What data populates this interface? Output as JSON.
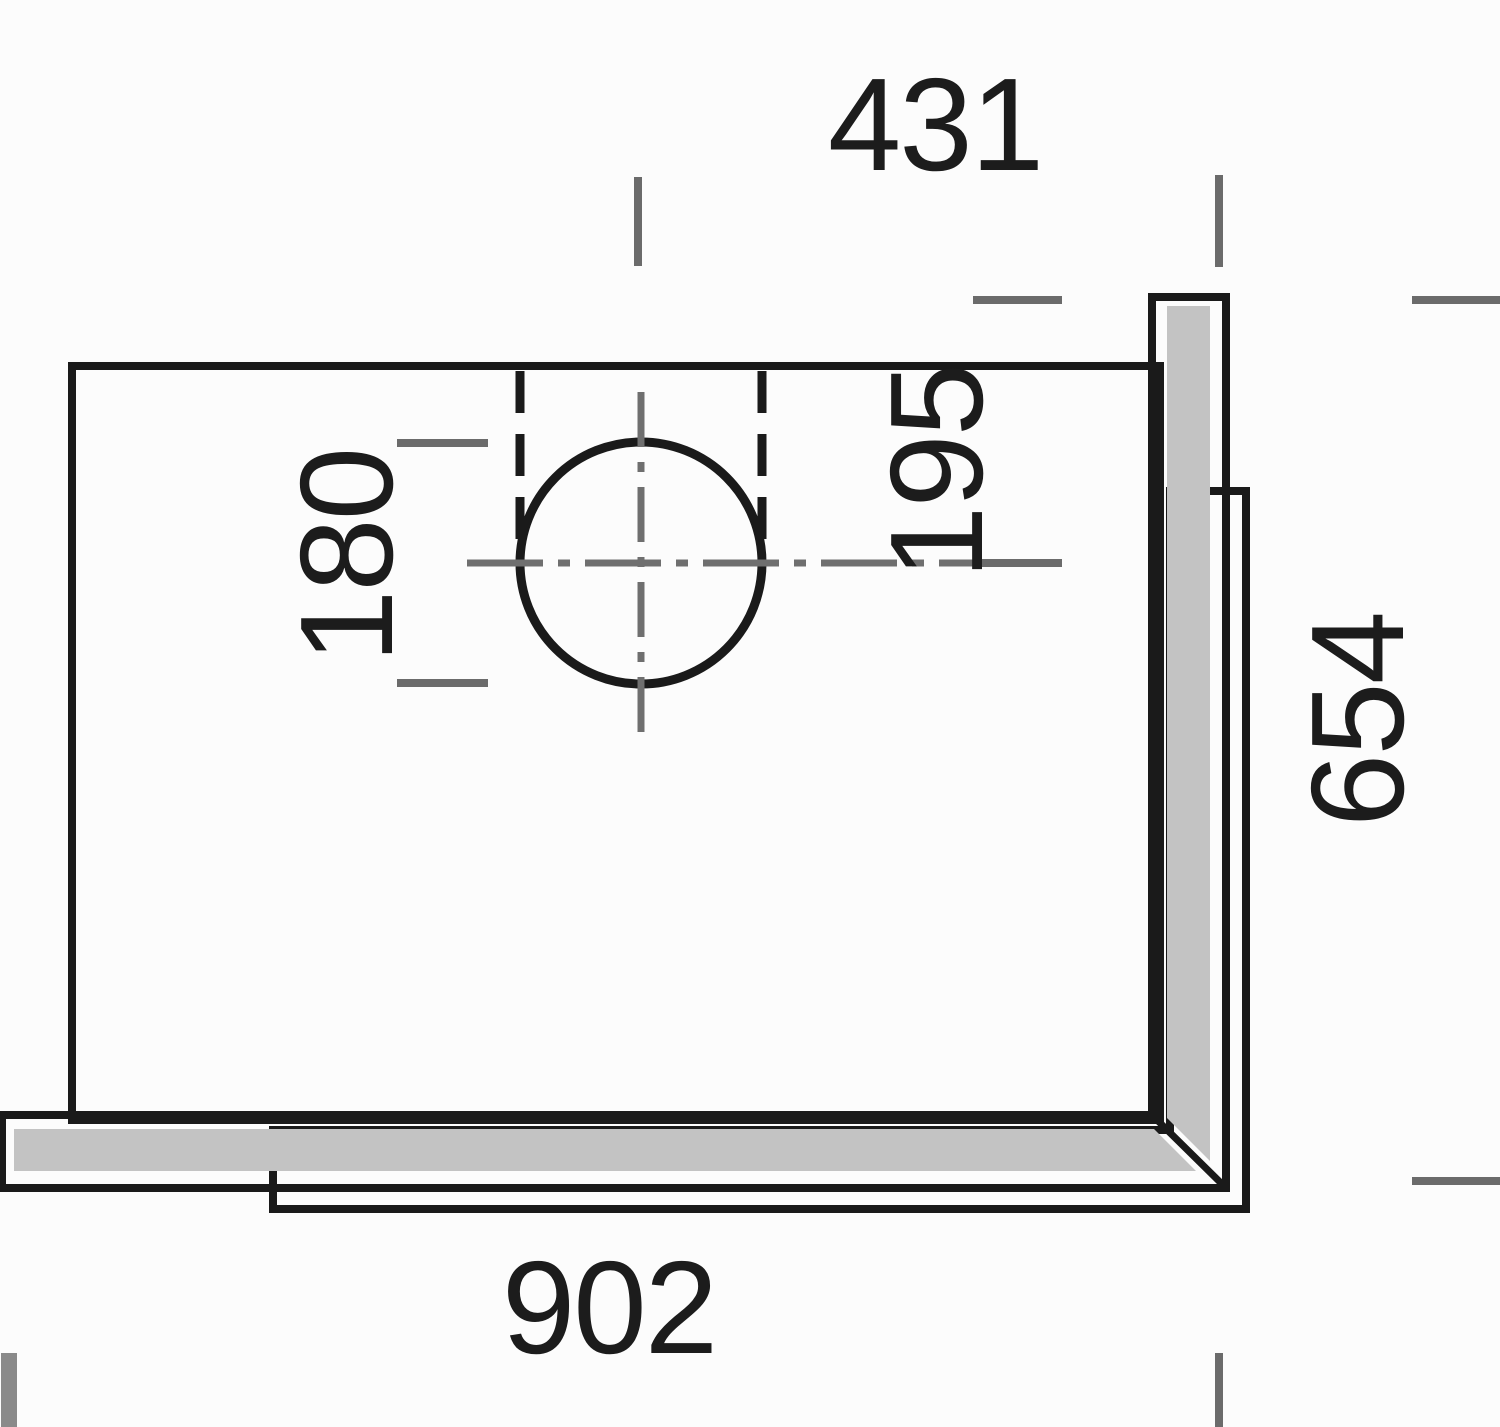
{
  "drawing": {
    "dimensions": {
      "top_width": "431",
      "hole_center_offset": "195",
      "hole_diameter": "180",
      "side_depth": "654",
      "bottom_width": "902"
    },
    "colors": {
      "line": "#1a1a1a",
      "panel_fill": "#c3c3c3",
      "panel_highlight": "#ffffff",
      "dimension_gray": "#6b6b6b",
      "background": "#fcfcfc"
    }
  }
}
